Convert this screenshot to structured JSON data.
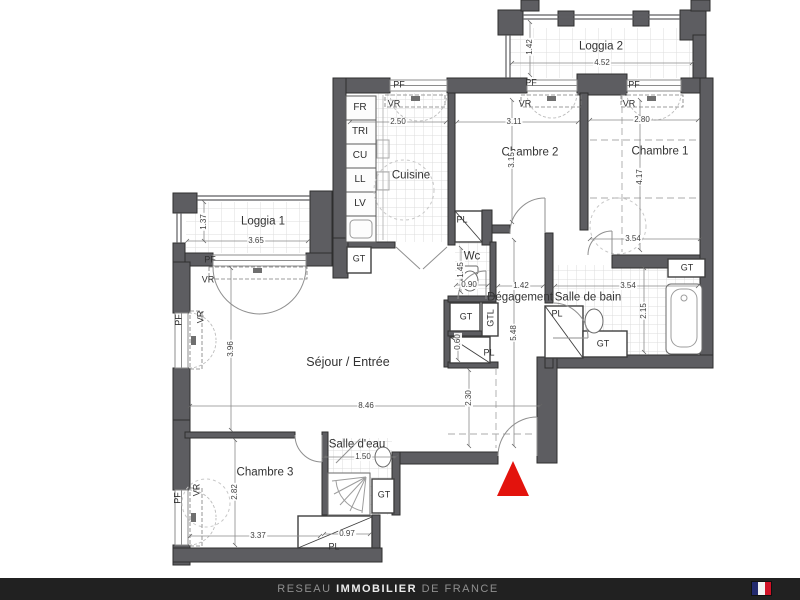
{
  "colors": {
    "wall": "#5d5d61",
    "line": "#3c3c3c",
    "entrance_marker": "#e3130d",
    "footer_bg": "#212121",
    "flag_blue": "#232a6e",
    "flag_white": "#f2f2f2",
    "flag_red": "#cf1126"
  },
  "plan": {
    "rooms": [
      {
        "id": "loggia-2",
        "label": "Loggia 2"
      },
      {
        "id": "chambre-1",
        "label": "Chambre 1"
      },
      {
        "id": "chambre-2",
        "label": "Chambre 2"
      },
      {
        "id": "cuisine",
        "label": "Cuisine"
      },
      {
        "id": "loggia-1",
        "label": "Loggia 1"
      },
      {
        "id": "wc",
        "label": "Wc"
      },
      {
        "id": "degagement",
        "label": "Dégagement"
      },
      {
        "id": "salle-de-bain",
        "label": "Salle de bain"
      },
      {
        "id": "sejour-entree",
        "label": "Séjour / Entrée"
      },
      {
        "id": "salle-d-eau",
        "label": "Salle d'eau"
      },
      {
        "id": "chambre-3",
        "label": "Chambre 3"
      }
    ],
    "dims": [
      {
        "value": "4.52"
      },
      {
        "value": "1.42"
      },
      {
        "value": "2.50"
      },
      {
        "value": "3.11"
      },
      {
        "value": "2.80"
      },
      {
        "value": "3.15"
      },
      {
        "value": "4.17"
      },
      {
        "value": "3.65"
      },
      {
        "value": "1.37"
      },
      {
        "value": "3.54"
      },
      {
        "value": "1.45"
      },
      {
        "value": "0.90"
      },
      {
        "value": "1.42"
      },
      {
        "value": "3.54"
      },
      {
        "value": "2.15"
      },
      {
        "value": "5.48"
      },
      {
        "value": "0.60"
      },
      {
        "value": "3.96"
      },
      {
        "value": "8.46"
      },
      {
        "value": "2.30"
      },
      {
        "value": "1.50"
      },
      {
        "value": "2.82"
      },
      {
        "value": "3.37"
      },
      {
        "value": "0.97"
      }
    ],
    "marks": [
      {
        "text": "FR"
      },
      {
        "text": "TRI"
      },
      {
        "text": "CU"
      },
      {
        "text": "LL"
      },
      {
        "text": "LV"
      },
      {
        "text": "PF"
      },
      {
        "text": "PF"
      },
      {
        "text": "PF"
      },
      {
        "text": "PF"
      },
      {
        "text": "PF"
      },
      {
        "text": "PF"
      },
      {
        "text": "VR"
      },
      {
        "text": "VR"
      },
      {
        "text": "VR"
      },
      {
        "text": "VR"
      },
      {
        "text": "VR"
      },
      {
        "text": "VR"
      },
      {
        "text": "GT"
      },
      {
        "text": "GT"
      },
      {
        "text": "GT"
      },
      {
        "text": "GT"
      },
      {
        "text": "GT"
      },
      {
        "text": "GTL"
      },
      {
        "text": "PL"
      },
      {
        "text": "PL"
      },
      {
        "text": "PL"
      },
      {
        "text": "PL"
      }
    ]
  },
  "footer": {
    "brand": {
      "part1": "RESEAU",
      "part2": "IMMOBILIER",
      "part3": "DE FRANCE"
    },
    "flag_icon": "french-flag"
  }
}
